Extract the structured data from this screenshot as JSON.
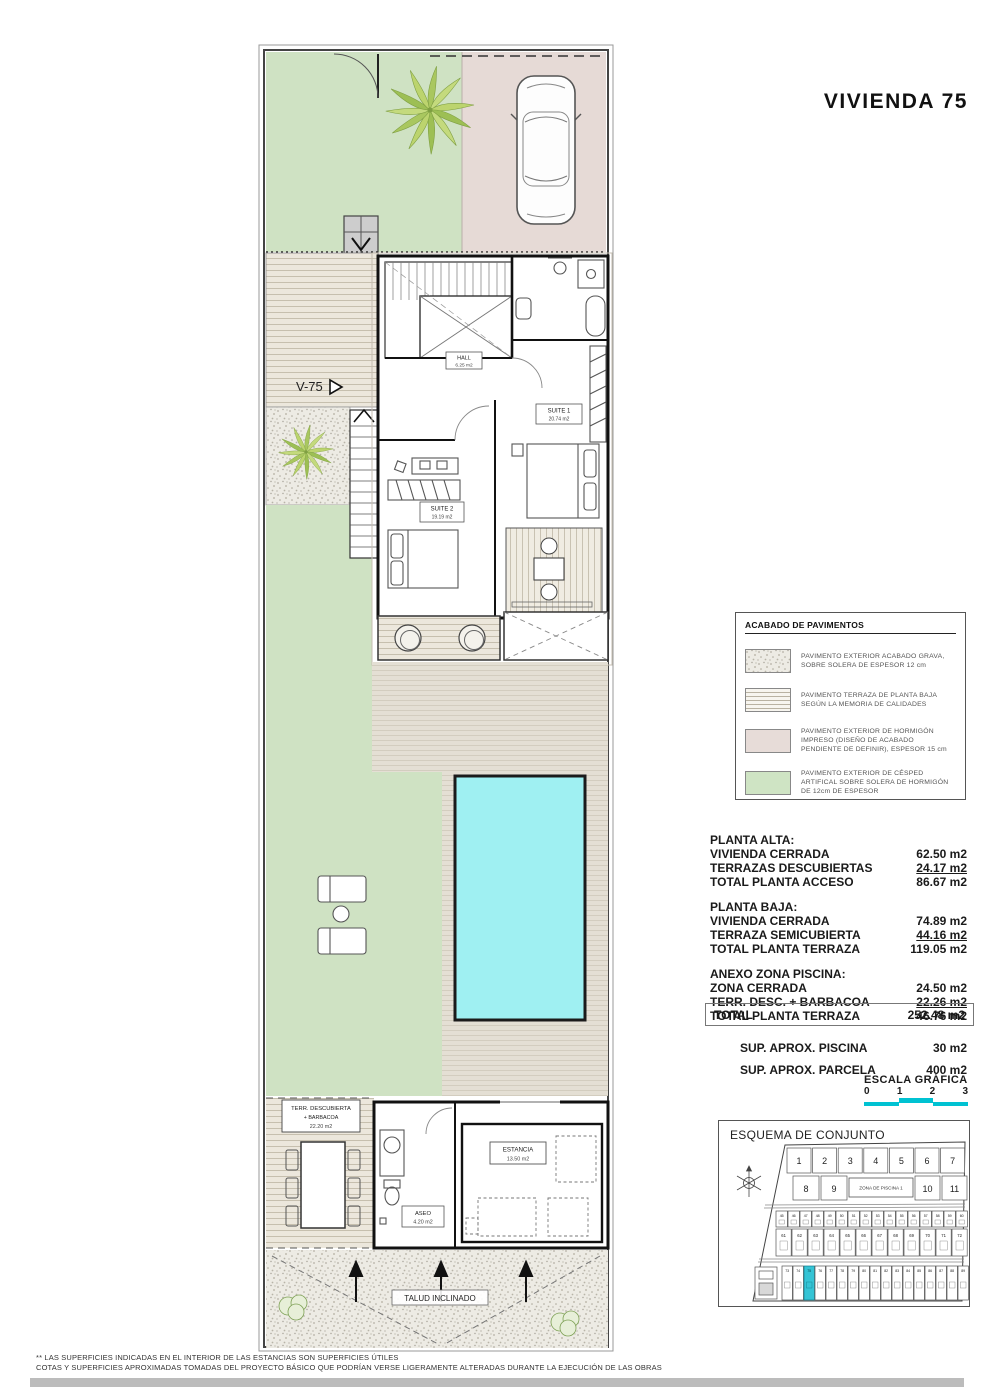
{
  "title": "VIVIENDA 75",
  "plan": {
    "unit_arrow_label": "V-75",
    "rooms": {
      "hall_name": "HALL",
      "hall_area": "6.25 m2",
      "suite1_name": "SUITE 1",
      "suite1_area": "20.74 m2",
      "suite2_name": "SUITE 2",
      "suite2_area": "19.19 m2",
      "estancia_name": "ESTANCIA",
      "estancia_area": "13.50 m2",
      "aseo_name": "ASEO",
      "aseo_area": "4.20 m2"
    },
    "terrace_label_line1": "TERR. DESCUBIERTA",
    "terrace_label_line2": "+ BARBACOA",
    "terrace_label_line3": "22.20 m2",
    "slope_label": "TALUD INCLINADO"
  },
  "legend": {
    "title": "ACABADO DE PAVIMENTOS",
    "items": [
      {
        "swatch": "gravel",
        "text": "PAVIMENTO EXTERIOR ACABADO GRAVA, SOBRE SOLERA DE ESPESOR 12 cm"
      },
      {
        "swatch": "stripes",
        "text": "PAVIMENTO TERRAZA DE PLANTA BAJA SEGÚN LA MEMORIA DE CALIDADES"
      },
      {
        "swatch": "pink",
        "text": "PAVIMENTO EXTERIOR DE HORMIGÓN IMPRESO (DISEÑO DE ACABADO PENDIENTE DE DEFINIR), ESPESOR 15 cm"
      },
      {
        "swatch": "green",
        "text": "PAVIMENTO EXTERIOR DE CÉSPED ARTIFICAL SOBRE SOLERA DE HORMIGÓN DE 12cm DE ESPESOR"
      }
    ]
  },
  "areas": {
    "groups": [
      {
        "heading": "PLANTA ALTA:",
        "rows": [
          {
            "label": "VIVIENDA CERRADA",
            "value": "62.50 m2",
            "underline": false
          },
          {
            "label": "TERRAZAS DESCUBIERTAS",
            "value": "24.17 m2",
            "underline": true
          },
          {
            "label": "TOTAL PLANTA ACCESO",
            "value": "86.67 m2",
            "underline": false
          }
        ]
      },
      {
        "heading": "PLANTA BAJA:",
        "rows": [
          {
            "label": "VIVIENDA CERRADA",
            "value": "74.89 m2",
            "underline": false
          },
          {
            "label": "TERRAZA SEMICUBIERTA",
            "value": "44.16 m2",
            "underline": true
          },
          {
            "label": "TOTAL PLANTA TERRAZA",
            "value": "119.05 m2",
            "underline": false
          }
        ]
      },
      {
        "heading": "ANEXO ZONA PISCINA:",
        "rows": [
          {
            "label": "ZONA CERRADA",
            "value": "24.50 m2",
            "underline": false
          },
          {
            "label": "TERR. DESC. + BARBACOA",
            "value": "22.26 m2",
            "underline": true
          },
          {
            "label": "TOTAL PLANTA TERRAZA",
            "value": "46.76 m2",
            "underline": false
          }
        ]
      }
    ],
    "total": {
      "label": "TOTAL",
      "value": "252.48 m2"
    },
    "extras": [
      {
        "label": "SUP.  APROX. PISCINA",
        "value": "30 m2"
      },
      {
        "label": "SUP.  APROX. PARCELA",
        "value": "400 m2"
      }
    ]
  },
  "scale": {
    "title": "ESCALA GRÁFICA",
    "ticks": [
      "0",
      "1",
      "2",
      "3"
    ]
  },
  "esquema": {
    "title": "ESQUEMA DE CONJUNTO",
    "pool_zone_label": "ZONA DE PISCINA 1",
    "row_top": [
      "1",
      "2",
      "3",
      "4",
      "5",
      "6",
      "7"
    ],
    "row_second_left": [
      "8",
      "9"
    ],
    "row_second_right": [
      "10",
      "11"
    ],
    "row_small_a": [
      "45",
      "46",
      "47",
      "48",
      "49",
      "50",
      "51",
      "52",
      "53",
      "54",
      "55",
      "56",
      "57",
      "58",
      "59",
      "60"
    ],
    "row_small_b": [
      "61",
      "62",
      "63",
      "64",
      "65",
      "66",
      "67",
      "68",
      "69",
      "70",
      "71",
      "72"
    ],
    "row_small_c": [
      "73",
      "74",
      "75",
      "76",
      "77",
      "78",
      "79",
      "80",
      "81",
      "82",
      "83",
      "84",
      "85",
      "86",
      "87",
      "88",
      "89"
    ],
    "highlighted_plot": "75"
  },
  "footer": {
    "line1": "** LAS SUPERFICIES INDICADAS EN EL INTERIOR DE LAS ESTANCIAS SON SUPERFICIES ÚTILES",
    "line2": "COTAS Y SUPERFICIES APROXIMADAS TOMADAS DEL PROYECTO BÁSICO QUE PODRÍAN VERSE LIGERAMENTE ALTERADAS DURANTE LA EJECUCIÓN DE LAS OBRAS"
  },
  "colors": {
    "lawn": "#cfe2c3",
    "driveway": "#e6dad6",
    "terrace_base": "#e4dfd4",
    "pool": "#9ff0f2",
    "scale_bar": "#00c2d2",
    "highlight": "#35c4d5"
  }
}
